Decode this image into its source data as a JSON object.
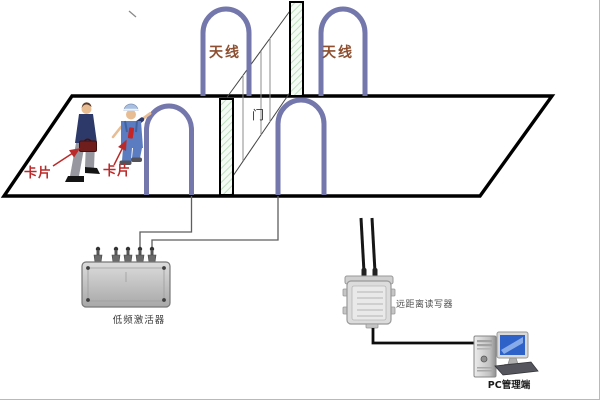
{
  "diagram": {
    "title_hint": "RFID long-range access gate system diagram",
    "labels": {
      "antenna_left": "天线",
      "antenna_right": "天线",
      "door": "门",
      "card_1": "卡片",
      "card_2": "卡片",
      "activator": "低频激活器",
      "reader": "远距离读写器",
      "pc": "PC管理端"
    },
    "colors": {
      "antenna_loop": "#7377ac",
      "antenna_label": "#8d4f2f",
      "card_label": "#bb2a2a",
      "structure_line": "#000000",
      "door_hatch": "#b2d8b2",
      "thin_line": "#888888",
      "wire": "#5e5e5e",
      "cable": "#0d0d0d",
      "device_body": "#c9c9c9",
      "monitor_screen": "#2e62c8",
      "card_red": "#c52525"
    }
  }
}
